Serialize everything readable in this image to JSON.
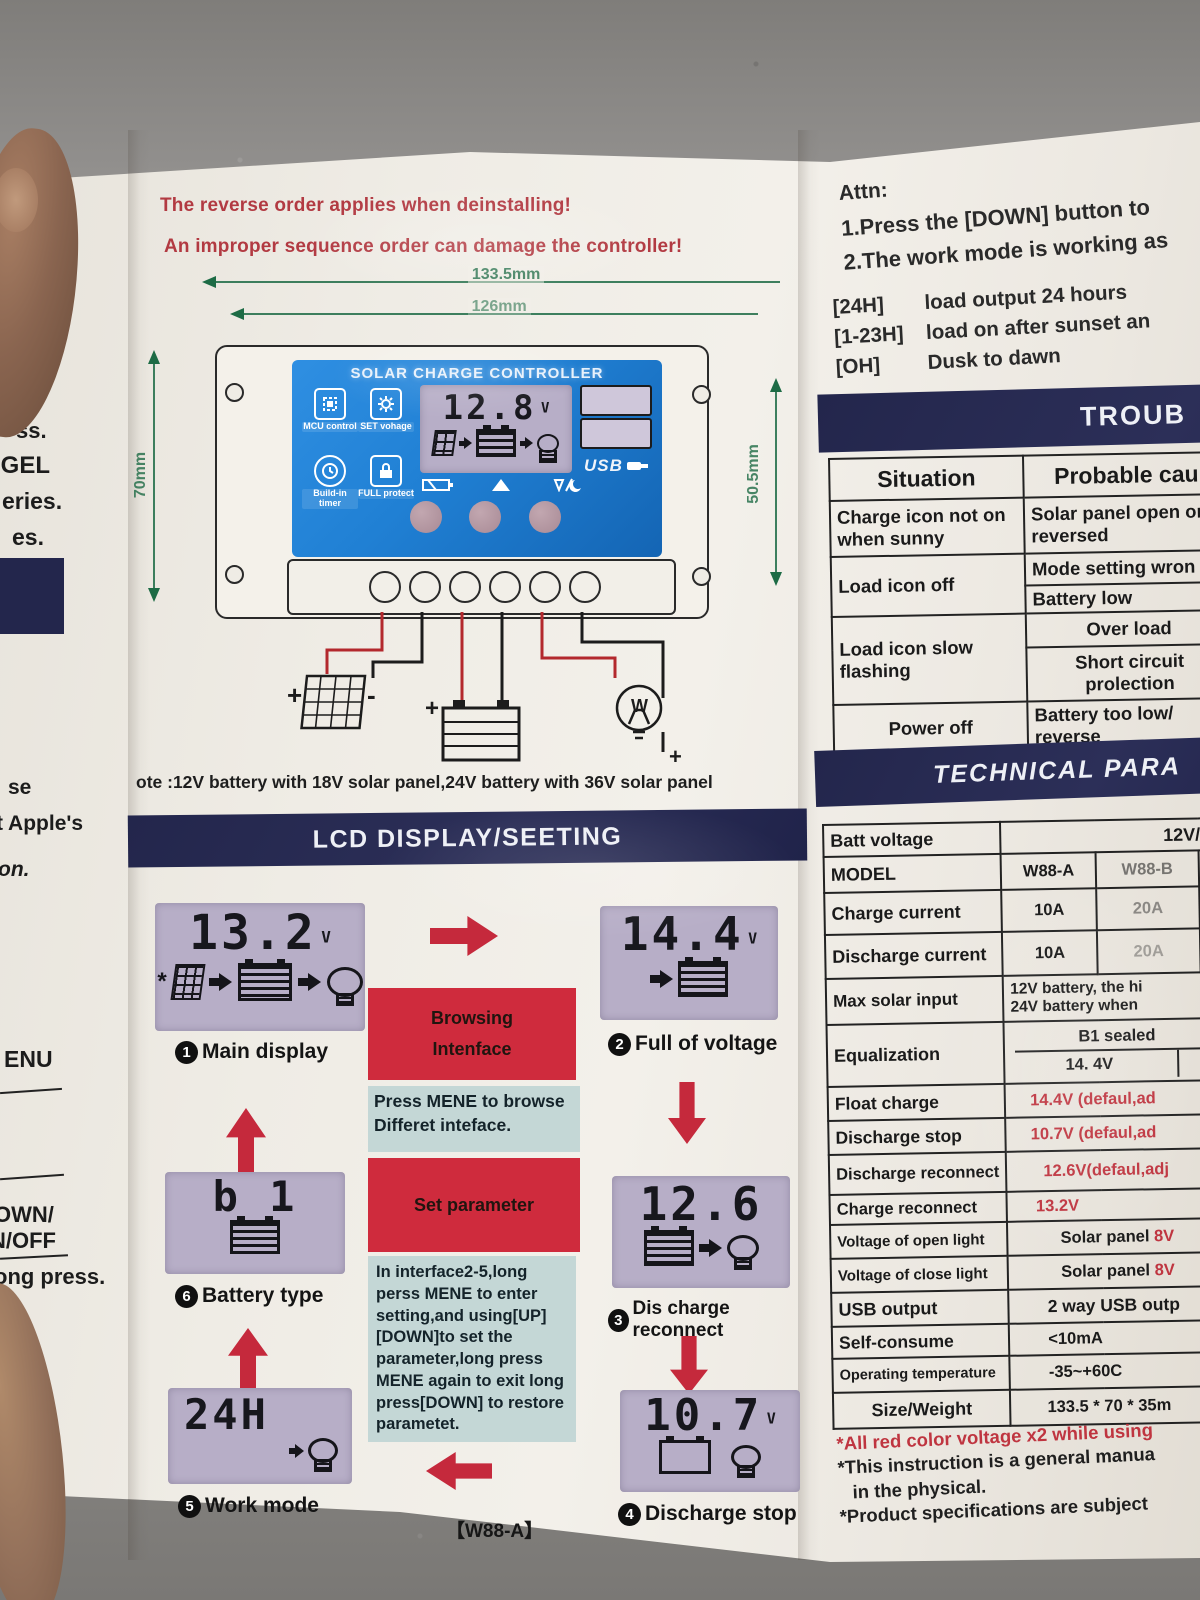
{
  "colors": {
    "navy": "#2a2d55",
    "accent_red": "#c5293c",
    "warning_red": "#b23a42",
    "face_blue": "#2180d6",
    "lcd_bg": "#b7aec7",
    "dim_green": "#1d6b45",
    "table_red_value": "#bf3540"
  },
  "left_strip": {
    "fragments": [
      "ss.",
      ",GEL",
      "eries.",
      "es.",
      "se",
      "t Apple's",
      "on.",
      "ENU",
      "OWN/",
      "N/OFF",
      "ong press."
    ]
  },
  "warnings": {
    "line1": "The reverse order applies when deinstalling!",
    "line2": "An improper sequence order can damage the controller!"
  },
  "dimensions": {
    "outer_width": "133.5mm",
    "inner_width": "126mm",
    "height_left": "70mm",
    "height_right": "50.5mm"
  },
  "controller": {
    "title": "SOLAR CHARGE CONTROLLER",
    "features": [
      {
        "label": "MCU control"
      },
      {
        "label": "SET vohage"
      },
      {
        "label": "Build-in timer"
      },
      {
        "label": "FULL protect"
      }
    ],
    "lcd": {
      "value": "12.8",
      "unit": "V"
    },
    "usb_label": "USB",
    "wire_plus": "+",
    "wire_minus": "-",
    "bulb_letter": "W"
  },
  "note": "ote :12V battery with 18V solar panel,24V battery with 36V solar panel",
  "lcd_section": {
    "header": "LCD DISPLAY/SEETING",
    "screens": {
      "main": {
        "num": "1",
        "value": "13.2",
        "unit": "V",
        "label": "Main display"
      },
      "full": {
        "num": "2",
        "value": "14.4",
        "unit": "V",
        "label": "Full of voltage"
      },
      "reconnect": {
        "num": "3",
        "value": "12.6",
        "unit": "",
        "label": "Dis charge reconnect"
      },
      "stop": {
        "num": "4",
        "value": "10.7",
        "unit": "V",
        "label": "Discharge stop"
      },
      "work": {
        "num": "5",
        "value": "24H",
        "unit": "",
        "label": "Work mode"
      },
      "battery": {
        "num": "6",
        "value": "b 1",
        "unit": "",
        "label": "Battery type"
      }
    },
    "instructions": {
      "box1_line1": "Browsing",
      "box1_line2": "Intenface",
      "box2": "Press MENE to browse Differet inteface.",
      "box3": "Set parameter",
      "box4": "In interface2-5,long perss MENE to enter setting,and using[UP] [DOWN]to set the parameter,long press MENE again to exit long press[DOWN] to restore parametet."
    },
    "footer_model": "【W88-A】"
  },
  "attn": {
    "title": "Attn:",
    "line1": "1.Press the [DOWN] button to",
    "line2": "2.The work mode is working as",
    "modes": [
      {
        "key": "[24H]",
        "desc": "load output 24 hours"
      },
      {
        "key": "[1-23H]",
        "desc": "load on after sunset an"
      },
      {
        "key": "[OH]",
        "desc": "Dusk to dawn"
      }
    ]
  },
  "trouble": {
    "header": "TROUB",
    "col_situation": "Situation",
    "col_cause": "Probable cau",
    "rows": [
      {
        "situation": "Charge icon not on when sunny",
        "cause1": "Solar panel open or reversed"
      },
      {
        "situation": "Load icon off",
        "cause1": "Mode setting wron",
        "cause2": "Battery low"
      },
      {
        "situation": "Load icon slow flashing",
        "cause1": "Over load",
        "cause2": "Short circuit prolection"
      },
      {
        "situation": "Power off",
        "cause1": "Battery too low/ reverse"
      }
    ]
  },
  "tech": {
    "header": "TECHNICAL PARA",
    "batt_voltage": {
      "label": "Batt voltage",
      "value": "12V/24V"
    },
    "model": {
      "label": "MODEL",
      "v1": "W88-A",
      "v2": "W88-B",
      "v3": "W88-"
    },
    "charge_current": {
      "label": "Charge current",
      "v1": "10A",
      "v2": "20A",
      "v3": "30A"
    },
    "discharge_current": {
      "label": "Discharge current",
      "v1": "10A",
      "v2": "20A",
      "v3": "30A"
    },
    "max_solar": {
      "label": "Max solar input",
      "line1": "12V battery, the hi",
      "line2": "24V battery when"
    },
    "equalization": {
      "label": "Equalization",
      "top": "B1 sealed",
      "bottom": "14. 4V"
    },
    "float_charge": {
      "label": "Float charge",
      "value": "14.4V (defaul,ad"
    },
    "discharge_stop": {
      "label": "Discharge stop",
      "value": "10.7V (defaul,ad"
    },
    "discharge_reconnect": {
      "label": "Discharge reconnect",
      "value": "12.6V(defaul,adj"
    },
    "charge_reconnect": {
      "label": "Charge reconnect",
      "value": "13.2V"
    },
    "open_light": {
      "label": "Voltage of open light",
      "value_black": "Solar panel ",
      "value_red": "8V"
    },
    "close_light": {
      "label": "Voltage of close light",
      "value_black": "Solar panel ",
      "value_red": "8V"
    },
    "usb_output": {
      "label": "USB output",
      "value": "2 way USB outp"
    },
    "self_consume": {
      "label": "Self-consume",
      "value": "<10mA"
    },
    "op_temp": {
      "label": "Operating temperature",
      "value": "-35~+60C"
    },
    "size_weight": {
      "label": "Size/Weight",
      "value": "133.5 * 70 * 35m"
    }
  },
  "footnotes": {
    "f1": "*All red color voltage x2 while using",
    "f2": "*This instruction is a general manua",
    "f3": "in the physical.",
    "f4": "*Product specifications are subject"
  }
}
